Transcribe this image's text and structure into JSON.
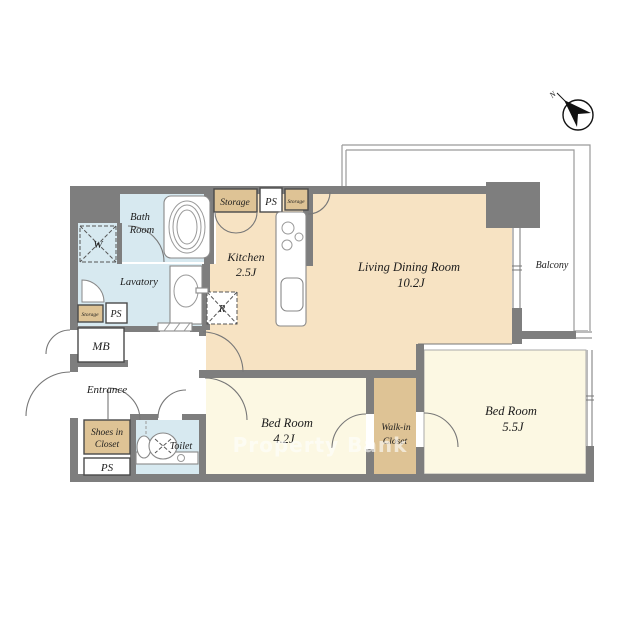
{
  "floorplan": {
    "watermark": "Property Bank",
    "compass": {
      "north_label": "N"
    },
    "rooms": {
      "living": {
        "name": "Living Dining Room",
        "size": "10.2J"
      },
      "kitchen": {
        "name": "Kitchen",
        "size": "2.5J"
      },
      "bedroom_1": {
        "name": "Bed Room",
        "size": "4.2J"
      },
      "bedroom_2": {
        "name": "Bed Room",
        "size": "5.5J"
      },
      "walk_in_closet": {
        "line1": "Walk-in",
        "line2": "Closet"
      },
      "bath": {
        "line1": "Bath",
        "line2": "Room"
      },
      "lavatory": {
        "name": "Lavatory"
      },
      "toilet": {
        "name": "Toilet"
      },
      "entrance": {
        "name": "Entrance"
      },
      "balcony": {
        "name": "Balcony"
      },
      "shoes_in_closet": {
        "line1": "Shoes in",
        "line2": "Closet"
      }
    },
    "fixtures": {
      "washing_machine": "W",
      "refrigerator": "R",
      "meter_box": "MB"
    },
    "utility": {
      "storage_top": "Storage",
      "storage_top_small": "Storage",
      "storage_left": "Storage",
      "ps_top": "PS",
      "ps_left": "PS",
      "ps_bottom": "PS"
    },
    "colors": {
      "wall": "#7e7e7e",
      "ldk_floor": "#f7e3c3",
      "bedroom_floor": "#fcf8e3",
      "wet_area": "#d7e9f0",
      "closet": "#dec395",
      "watermark": "#ffffff"
    }
  }
}
